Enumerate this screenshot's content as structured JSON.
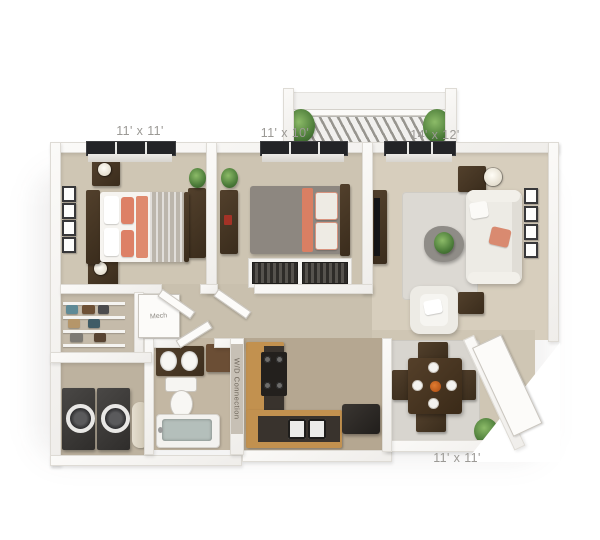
{
  "plan": {
    "type": "apartment-floor-plan-3d",
    "rooms": [
      {
        "name": "bedroom-1",
        "dimensions": "11' x 11'"
      },
      {
        "name": "bedroom-2",
        "dimensions": "11' x 10'"
      },
      {
        "name": "living-room",
        "dimensions": "14' x 12'"
      },
      {
        "name": "dining-room",
        "dimensions": "11' x 11'"
      }
    ],
    "annotations": {
      "mech_closet": "Mech",
      "washer_dryer": "W/D Connection"
    },
    "colors": {
      "background": "#ffffff",
      "wall": "#f6f5f2",
      "bedroom_carpet": "#cfc6b4",
      "living_floor": "#d7cebd",
      "kitchen_floor": "#b5a791",
      "cabinet_wood": "#c2914f",
      "countertop": "#39332d",
      "accent_coral": "#dd8066",
      "furniture_brown": "#43331f",
      "label_text": "#9b9995"
    }
  }
}
